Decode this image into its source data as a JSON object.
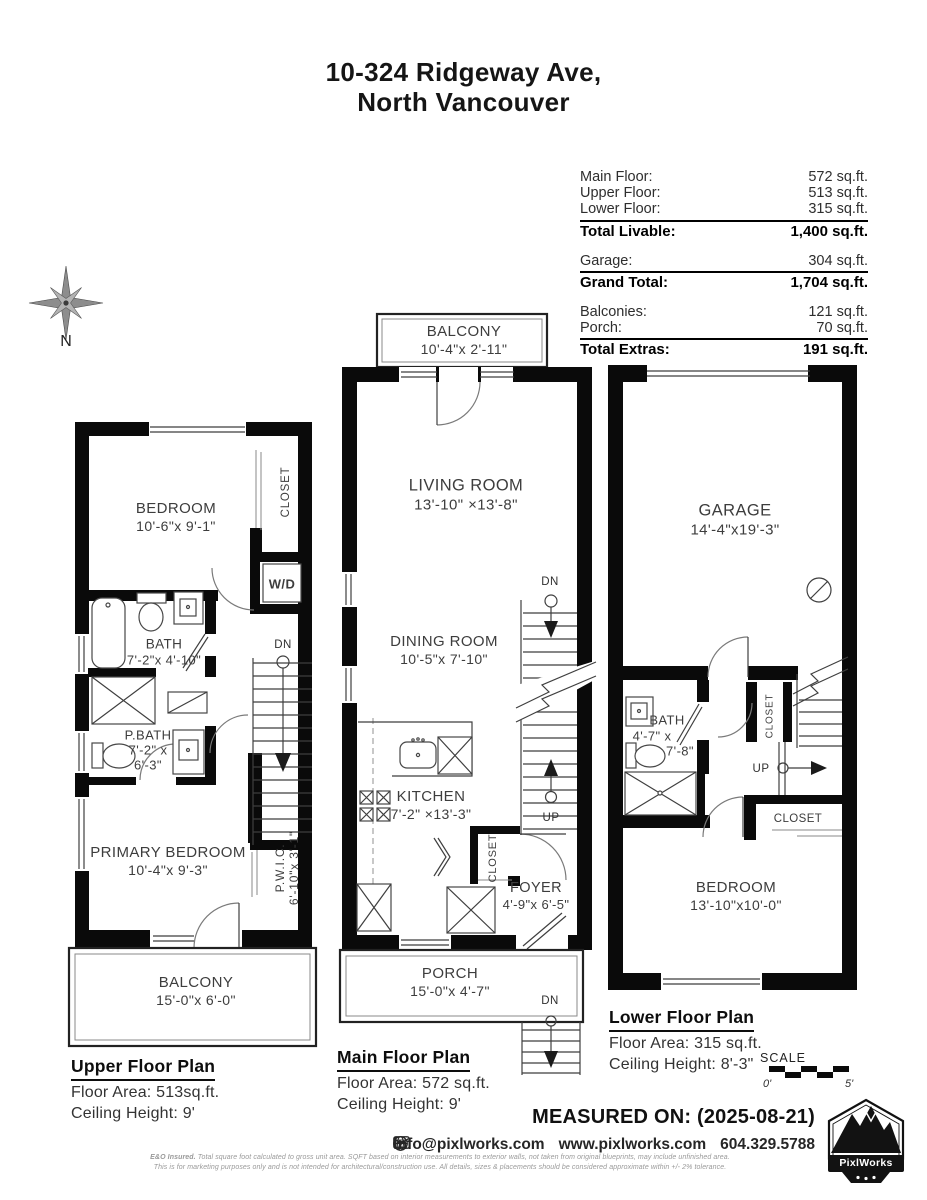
{
  "title": {
    "line1": "10-324 Ridgeway Ave,",
    "line2": "North Vancouver"
  },
  "compass": {
    "label": "N"
  },
  "area_table": {
    "rows": [
      {
        "label": "Main Floor:",
        "value": "572 sq.ft."
      },
      {
        "label": "Upper Floor:",
        "value": "513 sq.ft."
      },
      {
        "label": "Lower Floor:",
        "value": "315 sq.ft."
      },
      {
        "label": "Total Livable:",
        "value": "1,400 sq.ft."
      },
      {
        "label": "Garage:",
        "value": "304 sq.ft."
      },
      {
        "label": "Grand Total:",
        "value": "1,704 sq.ft."
      },
      {
        "label": "Balconies:",
        "value": "121 sq.ft."
      },
      {
        "label": "Porch:",
        "value": "70 sq.ft."
      },
      {
        "label": "Total Extras:",
        "value": "191 sq.ft."
      }
    ]
  },
  "plans": {
    "upper": {
      "title": "Upper Floor Plan",
      "area": "Floor Area: 513sq.ft.",
      "ceiling": "Ceiling Height: 9'",
      "bedroom_name": "BEDROOM",
      "bedroom_dims": "10'-6\"x 9'-1\"",
      "closet": "CLOSET",
      "wd": "W/D",
      "bath_name": "BATH",
      "bath_dims": "7'-2\"x 4'-10\"",
      "pbath_name": "P.BATH",
      "pbath_dims1": "7'-2\" x",
      "pbath_dims2": "6'-3\"",
      "primary_name": "PRIMARY BEDROOM",
      "primary_dims": "10'-4\"x 9'-3\"",
      "pwic_name": "P.W.I.C.",
      "pwic_dims": "6'-10\"x 3'-1\"",
      "balcony_name": "BALCONY",
      "balcony_dims": "15'-0\"x 6'-0\"",
      "dn": "DN"
    },
    "main": {
      "title": "Main Floor Plan",
      "area": "Floor Area: 572 sq.ft.",
      "ceiling": "Ceiling Height: 9'",
      "balcony_name": "BALCONY",
      "balcony_dims": "10'-4\"x 2'-11\"",
      "living_name": "LIVING ROOM",
      "living_dims": "13'-10\" ×13'-8\"",
      "dining_name": "DINING ROOM",
      "dining_dims": "10'-5\"x 7'-10\"",
      "kitchen_name": "KITCHEN",
      "kitchen_dims": "7'-2\" ×13'-3\"",
      "closet": "CLOSET",
      "foyer_name": "FOYER",
      "foyer_dims": "4'-9\"x 6'-5\"",
      "porch_name": "PORCH",
      "porch_dims": "15'-0\"x 4'-7\"",
      "dn": "DN",
      "up": "UP"
    },
    "lower": {
      "title": "Lower Floor Plan",
      "area": "Floor Area: 315 sq.ft.",
      "ceiling": "Ceiling Height: 8'-3\"",
      "garage_name": "GARAGE",
      "garage_dims": "14'-4\"x19'-3\"",
      "bath_name": "BATH",
      "bath_dims1": "4'-7\" x",
      "bath_dims2": "7'-8\"",
      "closet_top": "CLOSET",
      "closet_mid": "CLOSET",
      "bedroom_name": "BEDROOM",
      "bedroom_dims": "13'-10\"x10'-0\"",
      "up": "UP"
    }
  },
  "scale": {
    "label": "SCALE",
    "start": "0'",
    "end": "5'"
  },
  "footer": {
    "measured": "MEASURED ON: (2025-08-21)",
    "email": "info@pixlworks.com",
    "website": "www.pixlworks.com",
    "phone": "604.329.5788",
    "disclaimer1_bold": "E&O Insured.",
    "disclaimer1": " Total square foot calculated to gross unit area. SQFT based on interior measurements to exterior walls, not taken from original blueprints, may include unfinished area.",
    "disclaimer2": "This is for marketing purposes only and is not intended for architectural/construction use.  All details, sizes & placements should be considered approximate within +/- 2%  tolerance.",
    "logo_text": "PixlWorks"
  }
}
